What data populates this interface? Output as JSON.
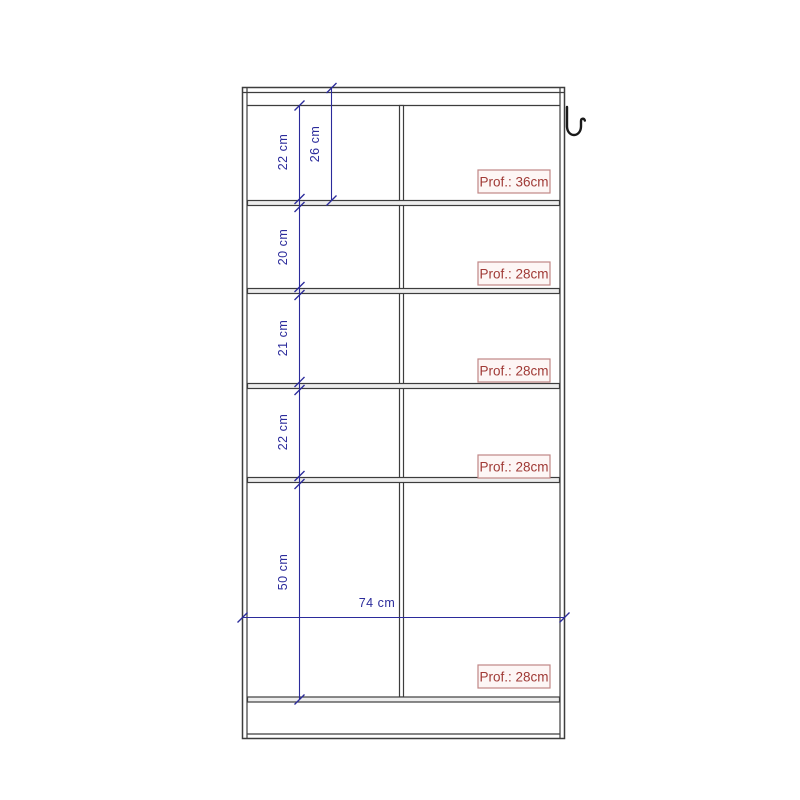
{
  "colors": {
    "background": "#ffffff",
    "line": "#3d3d3d",
    "panel_fill": "#ededed",
    "dimension": "#2b2b9b",
    "depth_text": "#a03a36",
    "depth_border": "#c08785",
    "depth_bg": "#fdf6f5",
    "hook": "#1a1a1a"
  },
  "diagram": {
    "type": "furniture-front-view-dimension-drawing",
    "unit": "cm",
    "overall_width_label": "74 cm",
    "section_heights": [
      {
        "id": "compartment-1-left",
        "label": "22 cm"
      },
      {
        "id": "compartment-1-full",
        "label": "26 cm"
      },
      {
        "id": "compartment-2",
        "label": "20 cm"
      },
      {
        "id": "compartment-3",
        "label": "21 cm"
      },
      {
        "id": "compartment-4",
        "label": "22 cm"
      },
      {
        "id": "compartment-5",
        "label": "50 cm"
      }
    ],
    "depth_labels": [
      {
        "text": "Prof.: 36cm"
      },
      {
        "text": "Prof.: 28cm"
      },
      {
        "text": "Prof.: 28cm"
      },
      {
        "text": "Prof.: 28cm"
      },
      {
        "text": "Prof.: 28cm"
      }
    ],
    "icons": [
      "coat-hook-icon"
    ]
  }
}
